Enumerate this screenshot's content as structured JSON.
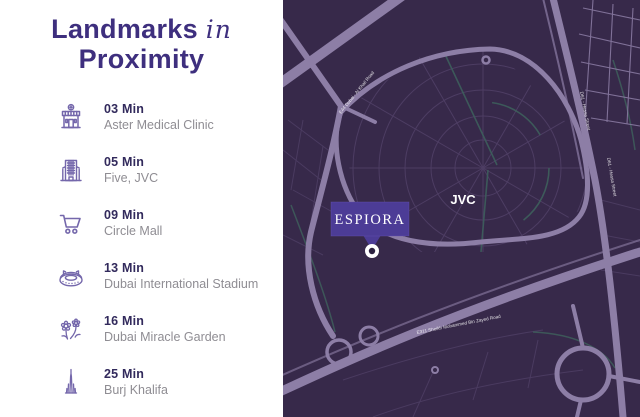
{
  "panel": {
    "title": {
      "word1": "Landmarks",
      "script": "in",
      "word2": "Proximity"
    },
    "landmarks": [
      {
        "time": "03 Min",
        "name": "Aster Medical Clinic",
        "icon": "clinic-icon"
      },
      {
        "time": "05 Min",
        "name": "Five, JVC",
        "icon": "hotel-icon"
      },
      {
        "time": "09 Min",
        "name": "Circle Mall",
        "icon": "cart-icon"
      },
      {
        "time": "13 Min",
        "name": "Dubai International Stadium",
        "icon": "stadium-icon"
      },
      {
        "time": "16 Min",
        "name": "Dubai Miracle Garden",
        "icon": "flowers-icon"
      },
      {
        "time": "25 Min",
        "name": "Burj Khalifa",
        "icon": "tower-icon"
      }
    ]
  },
  "map": {
    "area_label": "JVC",
    "project_badge": "ESPIORA",
    "road_labels": {
      "al_khail": "E44 Dubai - Al Khail Road",
      "hessa_upper": "D61 - Hessa Street",
      "hessa_lower": "D61 - Hessa Street",
      "smbz": "E311 Sheikh Mohammed Bin Zayed Road"
    },
    "colors": {
      "background": "#37294a",
      "road_major": "#8d7ea6",
      "road_minor": "#4d3d63",
      "accent_teal": "#3e5f5c",
      "badge": "#4c3c96",
      "label_text": "#ffffff",
      "title_text": "#3e2f7e"
    }
  }
}
